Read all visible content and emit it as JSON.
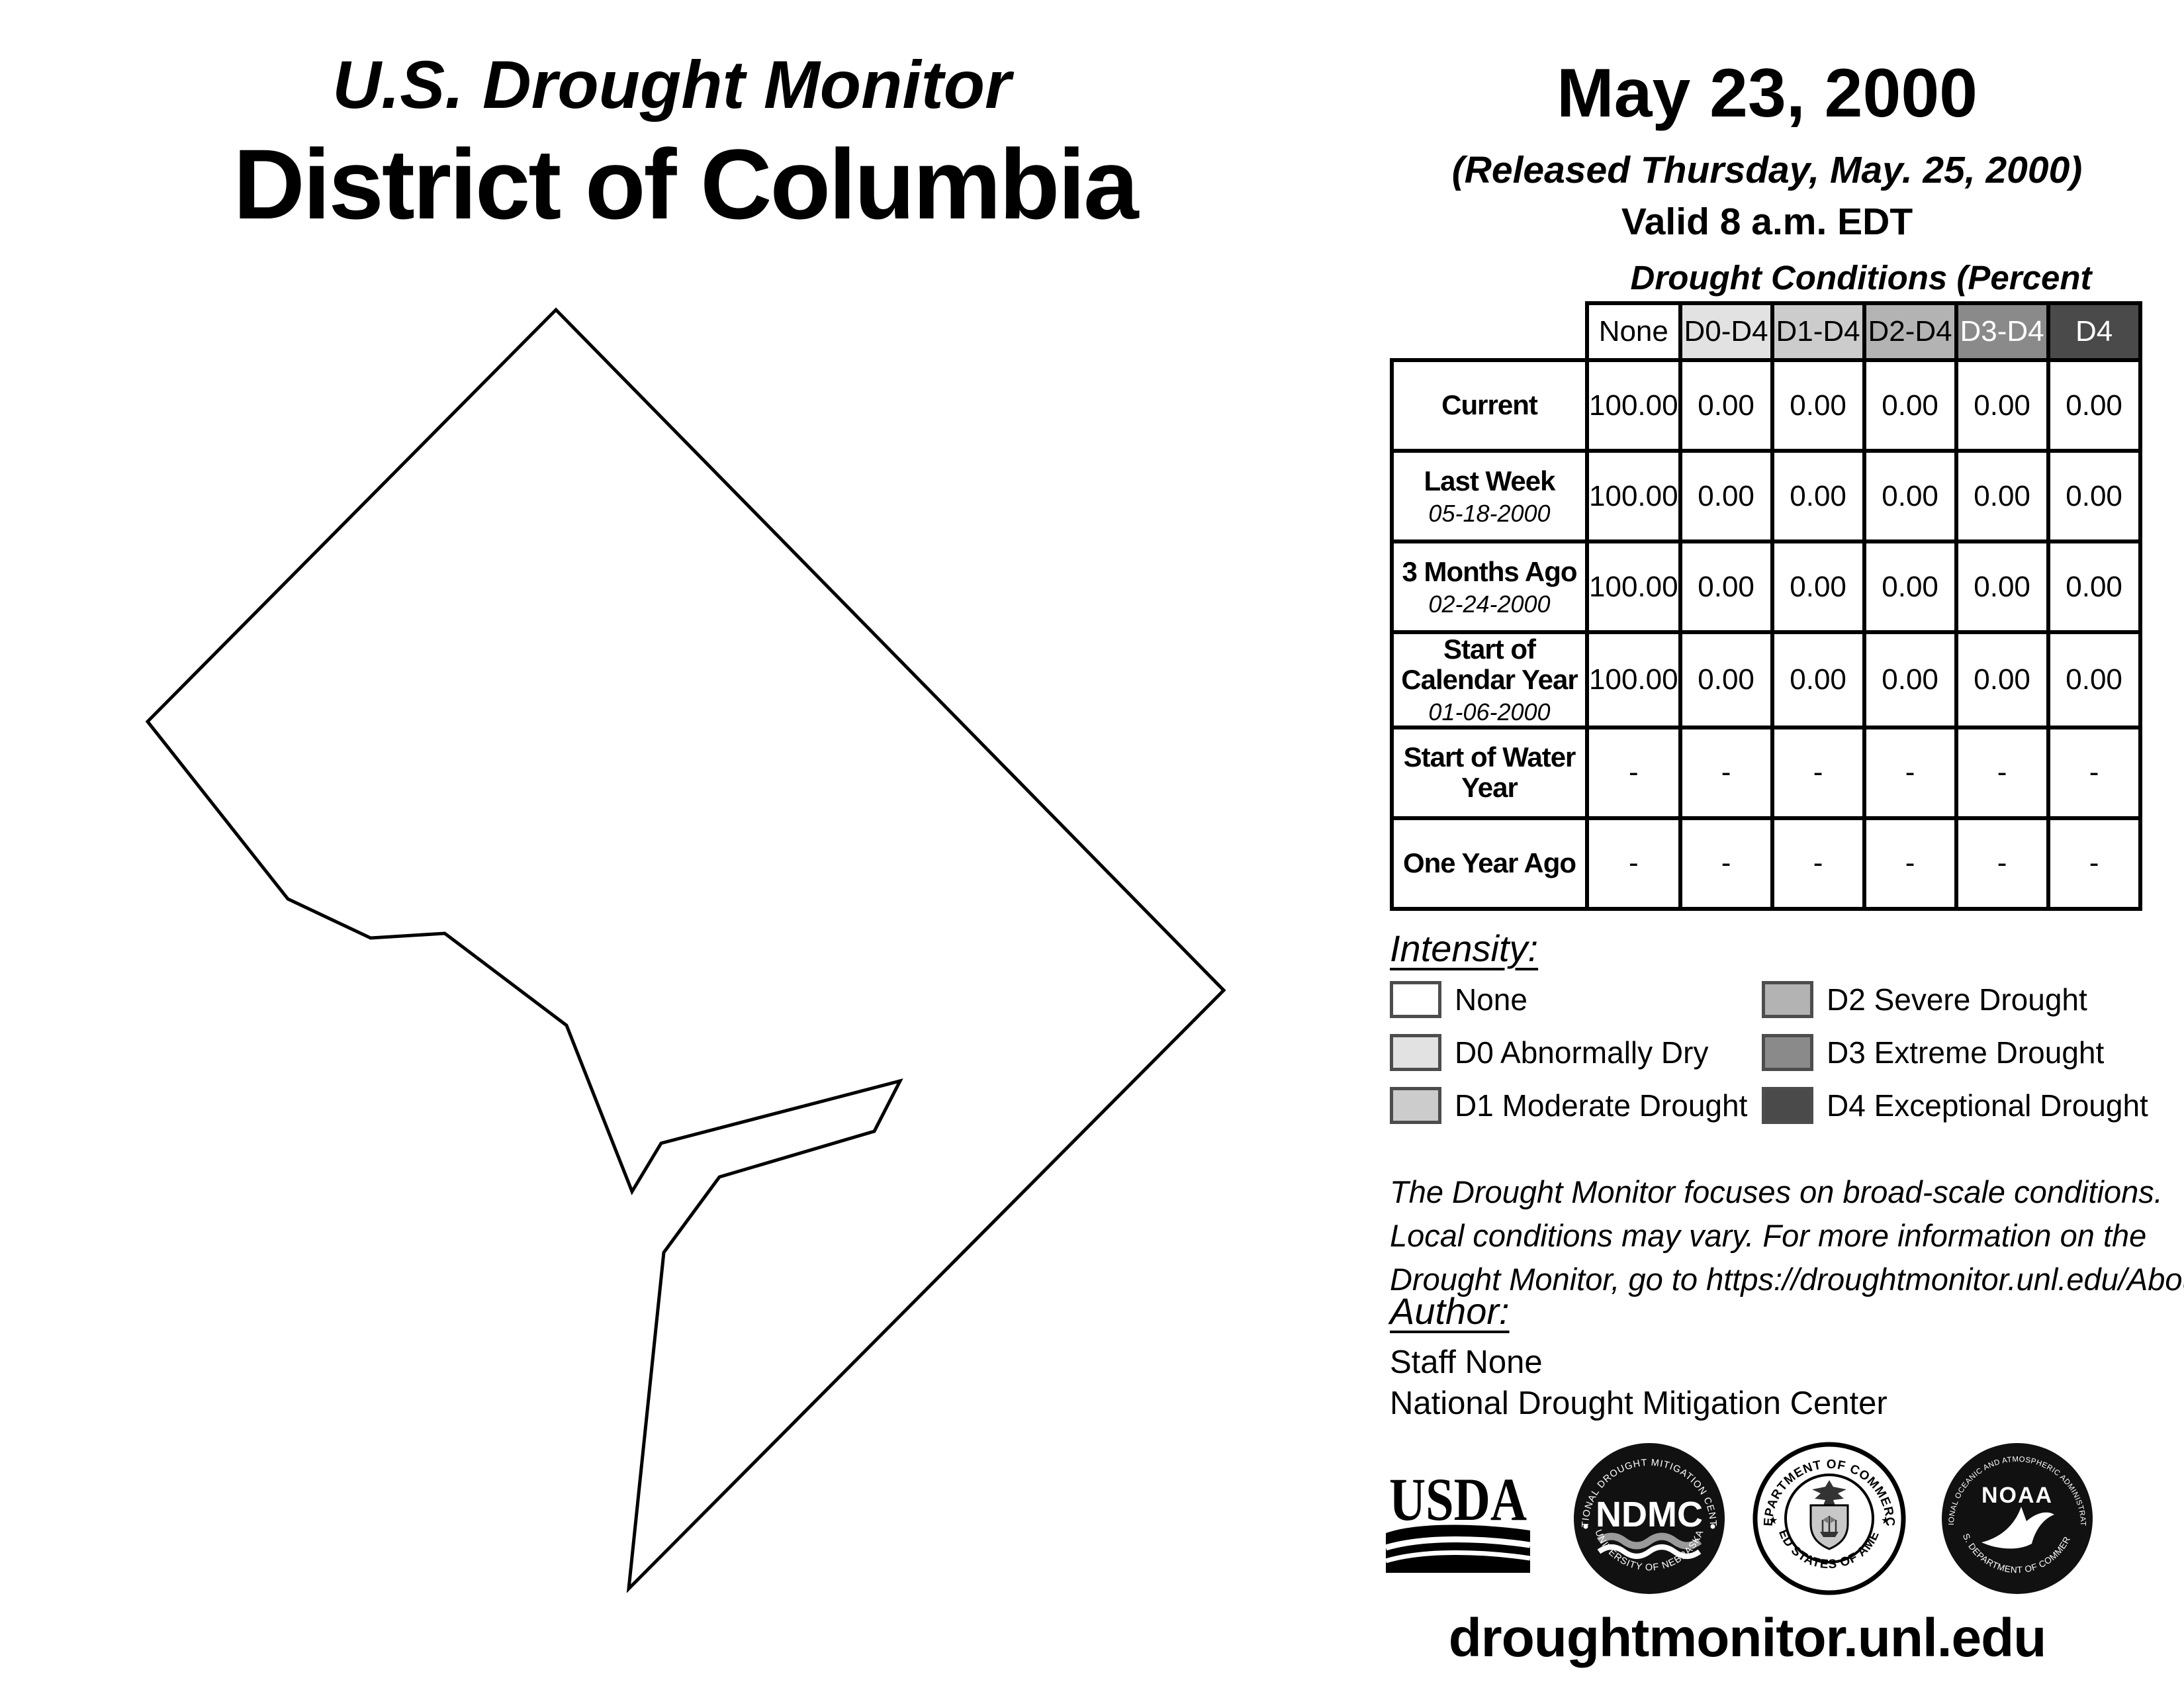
{
  "header": {
    "monitor_title": "U.S. Drought Monitor",
    "region_title": "District of Columbia",
    "date": "May 23, 2000",
    "released": "(Released Thursday, May. 25, 2000)",
    "valid": "Valid 8 a.m. EDT"
  },
  "map": {
    "region": "District of Columbia"
  },
  "table": {
    "title": "Drought Conditions (Percent Area)",
    "columns": [
      {
        "label": "None",
        "color": "#ffffff",
        "text_color": "#000000"
      },
      {
        "label": "D0-D4",
        "color": "#e2e2e2",
        "text_color": "#000000"
      },
      {
        "label": "D1-D4",
        "color": "#cccccc",
        "text_color": "#000000"
      },
      {
        "label": "D2-D4",
        "color": "#b3b3b3",
        "text_color": "#000000"
      },
      {
        "label": "D3-D4",
        "color": "#8a8a8a",
        "text_color": "#ffffff"
      },
      {
        "label": "D4",
        "color": "#4a4a4a",
        "text_color": "#ffffff"
      }
    ],
    "rows": [
      {
        "label": "Current",
        "date": "",
        "values": [
          "100.00",
          "0.00",
          "0.00",
          "0.00",
          "0.00",
          "0.00"
        ]
      },
      {
        "label": "Last Week",
        "date": "05-18-2000",
        "values": [
          "100.00",
          "0.00",
          "0.00",
          "0.00",
          "0.00",
          "0.00"
        ]
      },
      {
        "label": "3 Months Ago",
        "date": "02-24-2000",
        "values": [
          "100.00",
          "0.00",
          "0.00",
          "0.00",
          "0.00",
          "0.00"
        ]
      },
      {
        "label": "Start of Calendar Year",
        "date": "01-06-2000",
        "values": [
          "100.00",
          "0.00",
          "0.00",
          "0.00",
          "0.00",
          "0.00"
        ]
      },
      {
        "label": "Start of Water Year",
        "date": "",
        "values": [
          "-",
          "-",
          "-",
          "-",
          "-",
          "-"
        ]
      },
      {
        "label": "One Year Ago",
        "date": "",
        "values": [
          "-",
          "-",
          "-",
          "-",
          "-",
          "-"
        ]
      }
    ]
  },
  "legend": {
    "title": "Intensity:",
    "items": [
      {
        "label": "None",
        "color": "#ffffff"
      },
      {
        "label": "D0 Abnormally Dry",
        "color": "#e2e2e2"
      },
      {
        "label": "D1 Moderate Drought",
        "color": "#cccccc"
      },
      {
        "label": "D2 Severe Drought",
        "color": "#b3b3b3"
      },
      {
        "label": "D3 Extreme Drought",
        "color": "#8a8a8a"
      },
      {
        "label": "D4 Exceptional Drought",
        "color": "#4a4a4a"
      }
    ]
  },
  "disclaimer": {
    "lines": [
      "The Drought Monitor focuses on broad-scale conditions.",
      "Local conditions may vary. For more information on the",
      "Drought Monitor, go to https://droughtmonitor.unl.edu/About.aspx"
    ]
  },
  "author": {
    "title": "Author:",
    "name": "Staff None",
    "org": "National Drought Mitigation Center"
  },
  "logos": {
    "usda": {
      "text": "USDA"
    },
    "ndmc": {
      "top": "NATIONAL DROUGHT MITIGATION CENTER",
      "center": "NDMC",
      "bottom": "UNIVERSITY OF NEBRASKA"
    },
    "doc": {
      "top": "DEPARTMENT OF COMMERCE",
      "bottom": "UNITED STATES OF AMERICA"
    },
    "noaa": {
      "top": "NATIONAL OCEANIC AND ATMOSPHERIC ADMINISTRATION",
      "center": "NOAA",
      "bottom": "U.S. DEPARTMENT OF COMMERCE"
    }
  },
  "footer": {
    "url": "droughtmonitor.unl.edu"
  }
}
